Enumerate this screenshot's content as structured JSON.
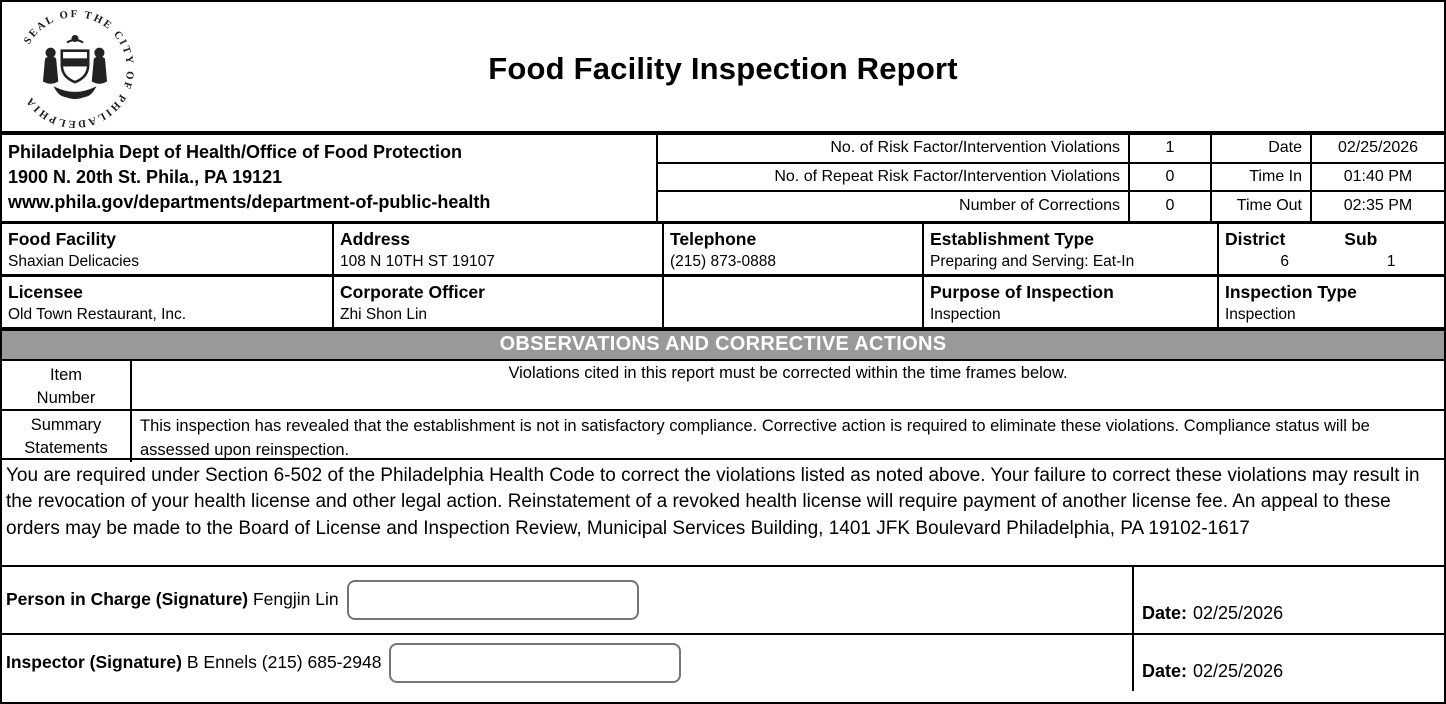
{
  "page": {
    "title": "Food Facility Inspection Report"
  },
  "seal": {
    "ring_text": "SEAL OF THE CITY OF PHILADELPHIA"
  },
  "agency": {
    "line1": "Philadelphia Dept of Health/Office of Food Protection",
    "line2": "1900 N. 20th St. Phila., PA 19121",
    "line3": "www.phila.gov/departments/department-of-public-health"
  },
  "stats": {
    "rows": [
      {
        "label": "No. of Risk Factor/Intervention Violations",
        "value": "1",
        "label2": "Date",
        "value2": "02/25/2026"
      },
      {
        "label": "No. of Repeat Risk Factor/Intervention Violations",
        "value": "0",
        "label2": "Time In",
        "value2": "01:40 PM"
      },
      {
        "label": "Number of Corrections",
        "value": "0",
        "label2": "Time Out",
        "value2": "02:35 PM"
      }
    ]
  },
  "facility": {
    "food_facility_label": "Food Facility",
    "food_facility": "Shaxian Delicacies",
    "address_label": "Address",
    "address": "108 N 10TH ST 19107",
    "telephone_label": "Telephone",
    "telephone": "(215) 873-0888",
    "establishment_type_label": "Establishment Type",
    "establishment_type": "Preparing and Serving: Eat-In",
    "district_label": "District",
    "district": "6",
    "sub_label": "Sub",
    "sub": "1"
  },
  "licensee": {
    "licensee_label": "Licensee",
    "licensee": "Old Town Restaurant, Inc.",
    "corporate_officer_label": "Corporate Officer",
    "corporate_officer": "Zhi Shon Lin",
    "telephone2": "",
    "purpose_label": "Purpose of Inspection",
    "purpose": "Inspection",
    "inspection_type_label": "Inspection Type",
    "inspection_type": "Inspection"
  },
  "observations": {
    "header": "OBSERVATIONS AND CORRECTIVE ACTIONS",
    "item_number_label": "Item\nNumber",
    "violations_note": "Violations cited in this report must be corrected within the time frames below.",
    "summary_label": "Summary\nStatements",
    "summary_text": "This inspection has revealed that the establishment is not in satisfactory compliance. Corrective action is required to eliminate these violations. Compliance status will be assessed upon reinspection."
  },
  "legal_notice": "You are required under Section 6-502 of the Philadelphia Health Code to correct the violations listed as noted above. Your failure to correct these violations may result in the revocation of your health license and other legal action. Reinstatement of a revoked health license will require payment of another license fee. An appeal to these orders may be made to the Board of License and Inspection Review, Municipal Services Building, 1401 JFK Boulevard Philadelphia, PA 19102-1617",
  "signatures": {
    "person_in_charge_label": "Person in Charge (Signature) ",
    "person_in_charge_name": "Fengjin Lin",
    "person_date_label": "Date:",
    "person_date": "02/25/2026",
    "inspector_label": "Inspector (Signature) ",
    "inspector_name": "B Ennels (215) 685-2948",
    "inspector_date_label": "Date:",
    "inspector_date": "02/25/2026"
  },
  "colors": {
    "bar_gray": "#999999",
    "border": "#000000",
    "signature_box_border": "#757575"
  }
}
